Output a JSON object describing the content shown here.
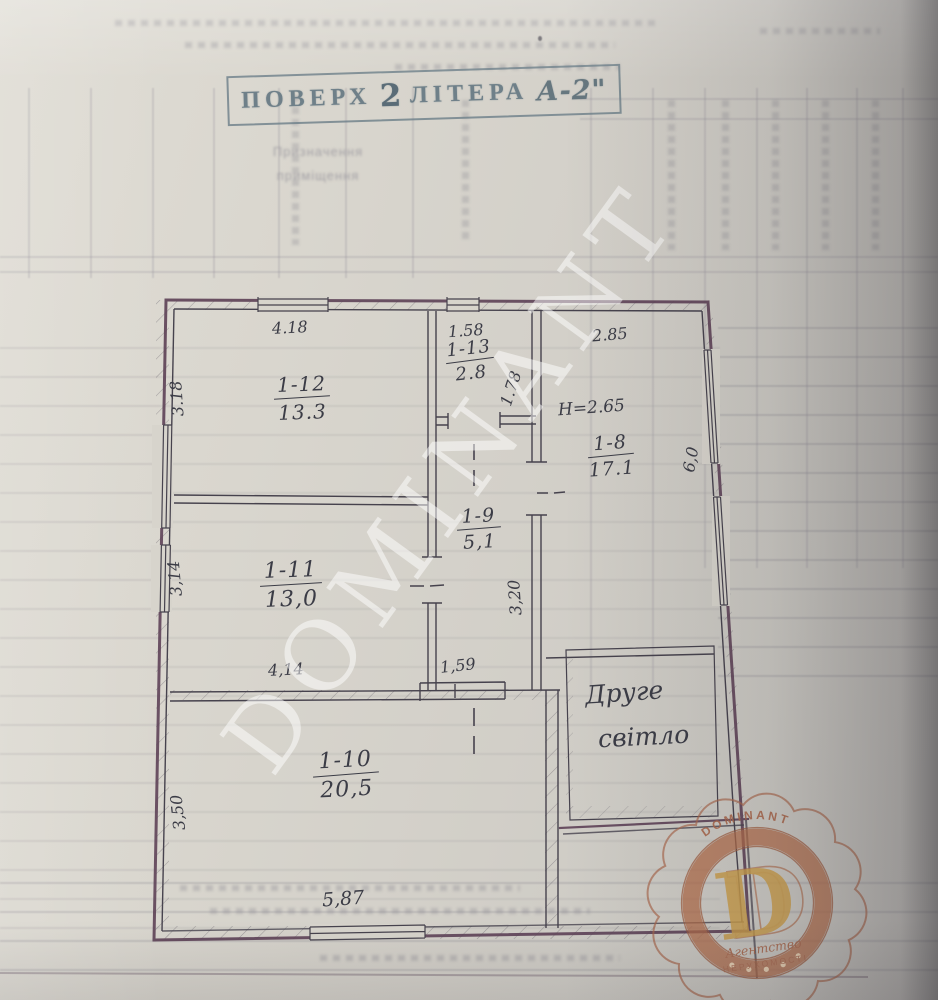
{
  "document": {
    "title_stamp": {
      "word1": "ПОВЕРХ",
      "number": "2",
      "word2": "ЛІТЕРА",
      "litera": "А-2\""
    },
    "bleed_text": {
      "line1": "Призначення",
      "line2": "приміщення"
    }
  },
  "plan": {
    "rooms": {
      "r12": {
        "id": "1-12",
        "area": "13.3"
      },
      "r13": {
        "id": "1-13",
        "area": "2.8"
      },
      "r8": {
        "id": "1-8",
        "area": "17.1"
      },
      "r9": {
        "id": "1-9",
        "area": "5,1"
      },
      "r11": {
        "id": "1-11",
        "area": "13,0"
      },
      "r10": {
        "id": "1-10",
        "area": "20,5"
      }
    },
    "dims": {
      "top_left": "4.18",
      "top_mid": "1.58",
      "top_right": "2.85",
      "left_top": "3.18",
      "room13_side": "1.78",
      "right_side": "6,0",
      "left_mid": "3,14",
      "hall_vert": "3,20",
      "room11_bottom": "4,14",
      "hall_bottom": "1,59",
      "left_bottom": "3,50",
      "bottom": "5,87"
    },
    "notes": {
      "ceiling_height": "Н=2.65",
      "second_light_line1": "Друге",
      "second_light_line2": "світло"
    }
  },
  "watermark": {
    "text": "DOMINANT"
  },
  "agency_stamp": {
    "arc_text": "DOMINANT",
    "monogram": "D",
    "line1": "Агентство",
    "line2": "НЕРУХОМОСТІ"
  },
  "colors": {
    "paper": "#d7d4cc",
    "ink": "#46424d",
    "outer_wall": "#5d4156",
    "title_ink": "#74858e",
    "copper": "#ab6a4b",
    "gold": "#c89c4a"
  }
}
